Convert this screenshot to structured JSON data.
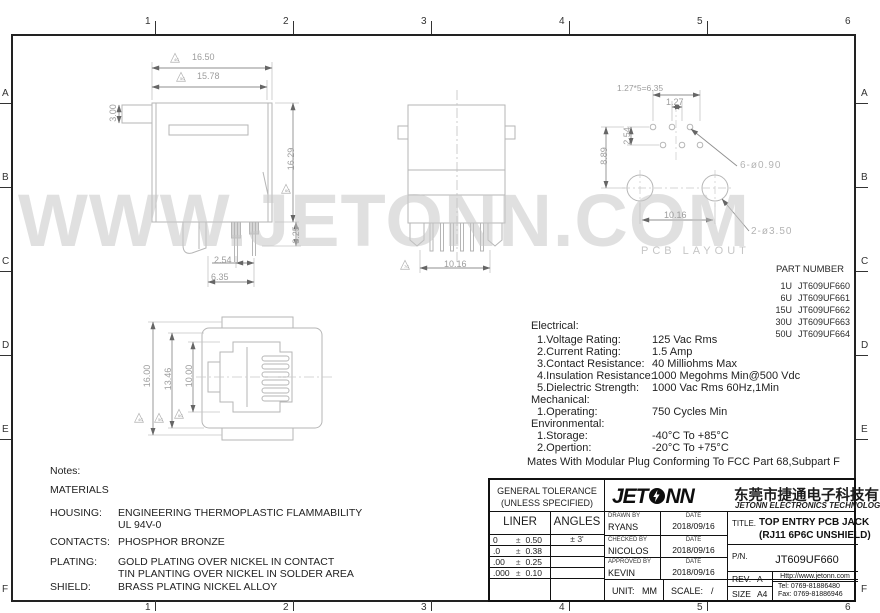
{
  "watermark": "WWW.JETONN.COM",
  "icons": {
    "flag_triangle": "△"
  },
  "colors": {
    "drawing_line": "#b6b6b6",
    "dim_text": "#9d9d9d",
    "watermark": "#c6c6c6",
    "frame": "#222222"
  },
  "border": {
    "top": [
      "1",
      "2",
      "3",
      "4",
      "5",
      "6"
    ],
    "bottom": [
      "1",
      "2",
      "3",
      "4",
      "5",
      "6"
    ],
    "left": [
      "A",
      "B",
      "C",
      "D",
      "E",
      "F"
    ],
    "right": [
      "A",
      "B",
      "C",
      "D",
      "E",
      "F"
    ]
  },
  "views": {
    "side_view": {
      "dim_width_outer": "16.50",
      "flag_width_outer": "4C",
      "dim_width_inner": "15.78",
      "flag_width_inner": "5C",
      "dim_height": "16.29",
      "flag_height": "6C",
      "dim_latch": "3.00",
      "dim_pin_height": "3.25",
      "dim_pin_pitch": "2.54",
      "dim_pin_span": "6.35"
    },
    "rear_view": {
      "dim_span": "10.16",
      "flag_span": "7C"
    },
    "pcb_layout": {
      "label": "PCB LAYOUT",
      "dim_pitch_total": "1.27*5=6.35",
      "dim_pitch": "1.27",
      "dim_row_gap": "2.54",
      "dim_height": "8.89",
      "dim_hole_span": "10.16",
      "callout_pin_holes": "6-ø0.90",
      "callout_mount_holes": "2-ø3.50"
    },
    "front_view": {
      "dim_height_outer": "16.00",
      "flag_outer": "4C",
      "dim_height_body": "13.46",
      "flag_body": "5C",
      "dim_height_opening": "10.00",
      "flag_opening": "6C"
    }
  },
  "part_table": {
    "title": "PART NUMBER",
    "rows": [
      {
        "code": "1U",
        "pn": "JT609UF660"
      },
      {
        "code": "6U",
        "pn": "JT609UF661"
      },
      {
        "code": "15U",
        "pn": "JT609UF662"
      },
      {
        "code": "30U",
        "pn": "JT609UF663"
      },
      {
        "code": "50U",
        "pn": "JT609UF664"
      }
    ]
  },
  "specs": {
    "electrical_header": "Electrical:",
    "electrical": [
      {
        "label": "1.Voltage Rating:",
        "value": "125 Vac Rms"
      },
      {
        "label": "2.Current Rating:",
        "value": "1.5 Amp"
      },
      {
        "label": "3.Contact Resistance:",
        "value": "40 Milliohms Max"
      },
      {
        "label": "4.Insulation Resistance:",
        "value": "1000 Megohms Min@500 Vdc"
      },
      {
        "label": "5.Dielectric Strength:",
        "value": "1000 Vac Rms 60Hz,1Min"
      }
    ],
    "mechanical_header": "Mechanical:",
    "mechanical": [
      {
        "label": "1.Operating:",
        "value": "750 Cycles Min"
      }
    ],
    "environmental_header": "Environmental:",
    "environmental": [
      {
        "label": "1.Storage:",
        "value": "-40°C To +85°C"
      },
      {
        "label": "2.Opertion:",
        "value": "-20°C To +75°C"
      }
    ],
    "footer": "Mates With Modular Plug Conforming To FCC Part 68,Subpart F"
  },
  "notes": {
    "title": "Notes:",
    "materials_header": "MATERIALS",
    "housing_label": "HOUSING:",
    "housing_value1": "ENGINEERING THERMOPLASTIC FLAMMABILITY",
    "housing_value2": "UL 94V-0",
    "contacts_label": "CONTACTS:",
    "contacts_value": "PHOSPHOR BRONZE",
    "plating_label": "PLATING:",
    "plating_value1": "GOLD PLATING OVER NICKEL IN CONTACT",
    "plating_value2": "TIN PLANTING OVER NICKEL IN SOLDER AREA",
    "shield_label": "SHIELD:",
    "shield_value": "BRASS PLATING NICKEL ALLOY"
  },
  "title_block": {
    "tolerance": {
      "header_line1": "GENERAL TOLERANCE",
      "header_line2": "(UNLESS SPECIFIED)",
      "col1": "LINER",
      "col2": "ANGLES",
      "rows": [
        {
          "digits": "0",
          "pm": "±",
          "tol": "0.50",
          "angle": "± 3'"
        },
        {
          "digits": ".0",
          "pm": "±",
          "tol": "0.38",
          "angle": ""
        },
        {
          "digits": ".00",
          "pm": "±",
          "tol": "0.25",
          "angle": ""
        },
        {
          "digits": ".000",
          "pm": "±",
          "tol": "0.10",
          "angle": ""
        }
      ]
    },
    "logo_text_1": "JET",
    "logo_text_2": "NN",
    "company_cn": "东莞市捷通电子科技有限公司",
    "company_en": "JETONN ELECTRONICS TECHNOLOGY",
    "sign_rows": [
      {
        "role": "DRAWN BY",
        "name": "RYANS",
        "date_label": "DATE",
        "date": "2018/09/16"
      },
      {
        "role": "CHECKED BY",
        "name": "NICOLOS",
        "date_label": "DATE",
        "date": "2018/09/16"
      },
      {
        "role": "APPROVED BY",
        "name": "KEVIN",
        "date_label": "DATE",
        "date": "2018/09/16"
      }
    ],
    "unit_label": "UNIT:",
    "unit": "MM",
    "scale_label": "SCALE:",
    "scale": "/",
    "title_label": "TITLE.",
    "title_line1": "TOP ENTRY PCB JACK",
    "title_line2": "(RJ11 6P6C UNSHIELD)",
    "pn_label": "P/N.",
    "pn": "JT609UF660",
    "rev_label": "REV.",
    "rev": "A",
    "size_label": "SIZE",
    "size": "A4",
    "url": "Http://www.jetonn.com",
    "tel": "Tel:  0769-81886480",
    "fax": "Fax: 0769-81886946"
  }
}
